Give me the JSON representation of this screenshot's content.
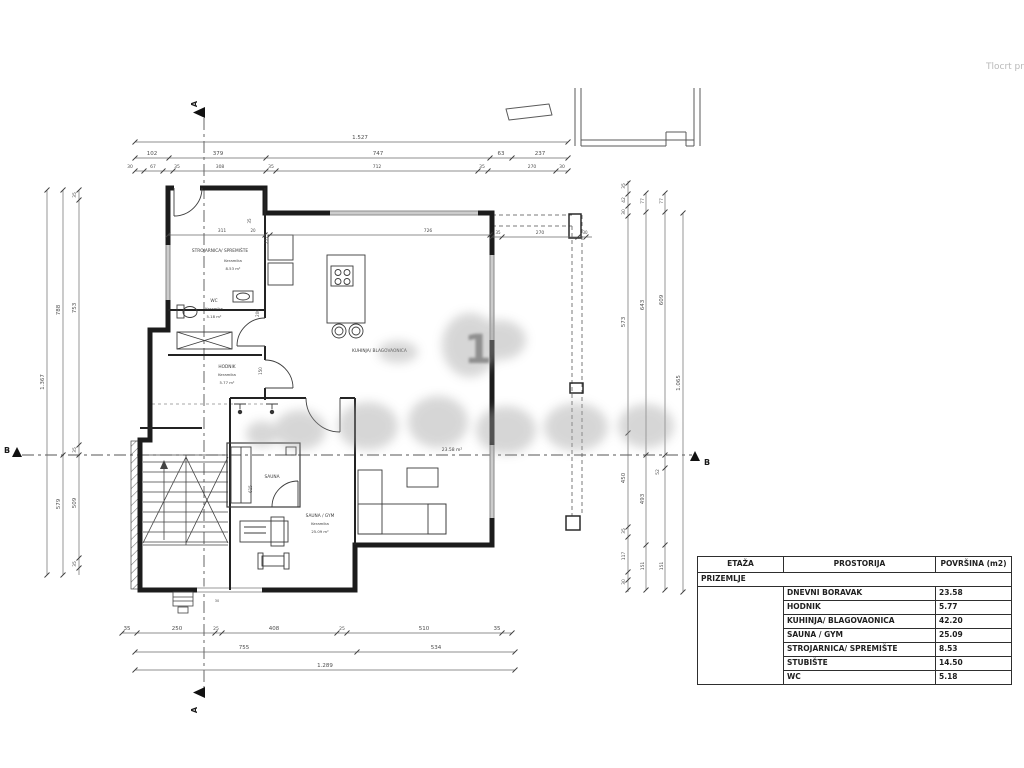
{
  "title": {
    "text": "Tlocrt pr"
  },
  "watermark": {
    "glyph": "1"
  },
  "table": {
    "headers": [
      "ETAŽA",
      "PROSTORIJA",
      "POVRŠINA (m2)"
    ],
    "floor_label": "PRIZEMLJE",
    "rows": [
      [
        "DNEVNI BORAVAK",
        "23.58"
      ],
      [
        "HODNIK",
        "5.77"
      ],
      [
        "KUHINJA/ BLAGOVAONICA",
        "42.20"
      ],
      [
        "SAUNA / GYM",
        "25.09"
      ],
      [
        "STROJARNICA/ SPREMIŠTE",
        "8.53"
      ],
      [
        "STUBIŠTE",
        "14.50"
      ],
      [
        "WC",
        "5.18"
      ]
    ]
  },
  "plan_labels": [
    {
      "t": "1.527",
      "x": 360,
      "y": 139
    },
    {
      "t": "102",
      "x": 152,
      "y": 155
    },
    {
      "t": "379",
      "x": 218,
      "y": 155
    },
    {
      "t": "747",
      "x": 378,
      "y": 155
    },
    {
      "t": "63",
      "x": 501,
      "y": 155
    },
    {
      "t": "237",
      "x": 540,
      "y": 155
    },
    {
      "t": "30",
      "x": 130,
      "y": 168,
      "s": 4.5
    },
    {
      "t": "67",
      "x": 153,
      "y": 168,
      "s": 4.5
    },
    {
      "t": "35",
      "x": 177,
      "y": 168,
      "s": 4.5
    },
    {
      "t": "308",
      "x": 220,
      "y": 168,
      "s": 4.5
    },
    {
      "t": "35",
      "x": 271,
      "y": 168,
      "s": 4.5
    },
    {
      "t": "712",
      "x": 377,
      "y": 168,
      "s": 4.5
    },
    {
      "t": "35",
      "x": 482,
      "y": 168,
      "s": 4.5
    },
    {
      "t": "270",
      "x": 532,
      "y": 168,
      "s": 4.5
    },
    {
      "t": "30",
      "x": 562,
      "y": 168,
      "s": 4.5
    },
    {
      "t": "311",
      "x": 222,
      "y": 232,
      "s": 4.5
    },
    {
      "t": "20",
      "x": 253,
      "y": 232,
      "s": 4
    },
    {
      "t": "726",
      "x": 428,
      "y": 232,
      "s": 4.5
    },
    {
      "t": "35",
      "x": 498,
      "y": 234,
      "s": 4
    },
    {
      "t": "270",
      "x": 540,
      "y": 234,
      "s": 4.5
    },
    {
      "t": "30",
      "x": 585,
      "y": 234,
      "s": 4
    },
    {
      "t": "35",
      "x": 251,
      "y": 221,
      "s": 4,
      "r": -90
    },
    {
      "t": "277",
      "x": 268,
      "y": 240,
      "s": 4,
      "r": -90
    },
    {
      "t": "200",
      "x": 259,
      "y": 313,
      "s": 4,
      "r": -90
    },
    {
      "t": "150",
      "x": 262,
      "y": 371,
      "s": 4,
      "r": -90
    },
    {
      "t": "615",
      "x": 252,
      "y": 489,
      "s": 4,
      "r": -90
    },
    {
      "t": "30",
      "x": 217,
      "y": 602,
      "s": 3.5
    },
    {
      "t": "1.367",
      "x": 44,
      "y": 382,
      "r": -90
    },
    {
      "t": "788",
      "x": 60,
      "y": 310,
      "r": -90
    },
    {
      "t": "579",
      "x": 60,
      "y": 504,
      "r": -90
    },
    {
      "t": "35",
      "x": 76,
      "y": 195,
      "r": -90,
      "s": 4.5
    },
    {
      "t": "753",
      "x": 76,
      "y": 308,
      "r": -90
    },
    {
      "t": "35",
      "x": 76,
      "y": 450,
      "r": -90,
      "s": 4.5
    },
    {
      "t": "509",
      "x": 76,
      "y": 503,
      "r": -90
    },
    {
      "t": "35",
      "x": 76,
      "y": 564,
      "r": -90,
      "s": 4.5
    },
    {
      "t": "35",
      "x": 625,
      "y": 186,
      "r": -90,
      "s": 4.5
    },
    {
      "t": "42",
      "x": 625,
      "y": 200,
      "r": -90,
      "s": 4.5
    },
    {
      "t": "30",
      "x": 625,
      "y": 212,
      "r": -90,
      "s": 4.5
    },
    {
      "t": "573",
      "x": 625,
      "y": 322,
      "r": -90
    },
    {
      "t": "450",
      "x": 625,
      "y": 478,
      "r": -90
    },
    {
      "t": "35",
      "x": 625,
      "y": 531,
      "r": -90,
      "s": 4.5
    },
    {
      "t": "117",
      "x": 625,
      "y": 556,
      "r": -90,
      "s": 4.5
    },
    {
      "t": "30",
      "x": 625,
      "y": 582,
      "r": -90,
      "s": 4.5
    },
    {
      "t": "77",
      "x": 644,
      "y": 201,
      "r": -90,
      "s": 4.5
    },
    {
      "t": "643",
      "x": 644,
      "y": 305,
      "r": -90
    },
    {
      "t": "493",
      "x": 644,
      "y": 499,
      "r": -90
    },
    {
      "t": "151",
      "x": 644,
      "y": 566,
      "r": -90,
      "s": 4.5
    },
    {
      "t": "77",
      "x": 663,
      "y": 201,
      "r": -90,
      "s": 4.5
    },
    {
      "t": "609",
      "x": 663,
      "y": 300,
      "r": -90
    },
    {
      "t": "52",
      "x": 659,
      "y": 472,
      "r": -90,
      "s": 4.5
    },
    {
      "t": "151",
      "x": 663,
      "y": 566,
      "r": -90,
      "s": 4.5
    },
    {
      "t": "1.065",
      "x": 680,
      "y": 383,
      "r": -90
    },
    {
      "t": "35",
      "x": 127,
      "y": 630
    },
    {
      "t": "250",
      "x": 177,
      "y": 630
    },
    {
      "t": "25",
      "x": 216,
      "y": 630,
      "s": 4.5
    },
    {
      "t": "408",
      "x": 274,
      "y": 630
    },
    {
      "t": "25",
      "x": 342,
      "y": 630,
      "s": 4.5
    },
    {
      "t": "510",
      "x": 424,
      "y": 630
    },
    {
      "t": "35",
      "x": 497,
      "y": 630
    },
    {
      "t": "755",
      "x": 244,
      "y": 649
    },
    {
      "t": "534",
      "x": 436,
      "y": 649
    },
    {
      "t": "1.289",
      "x": 325,
      "y": 667
    },
    {
      "t": "STROJARNICA/ SPREMIŠTE",
      "x": 220,
      "y": 252,
      "s": 4.3,
      "cls": "room"
    },
    {
      "t": "Keramika",
      "x": 233,
      "y": 262,
      "s": 3.8,
      "cls": "room"
    },
    {
      "t": "8.53 m²",
      "x": 233,
      "y": 270,
      "s": 3.8,
      "cls": "room"
    },
    {
      "t": "WC",
      "x": 214,
      "y": 302,
      "s": 4.3,
      "cls": "room"
    },
    {
      "t": "Keramika",
      "x": 214,
      "y": 310,
      "s": 3.8,
      "cls": "room"
    },
    {
      "t": "5.18 m²",
      "x": 214,
      "y": 318,
      "s": 3.8,
      "cls": "room"
    },
    {
      "t": "HODNIK",
      "x": 227,
      "y": 368,
      "s": 4.3,
      "cls": "room"
    },
    {
      "t": "Keramika",
      "x": 227,
      "y": 376,
      "s": 3.8,
      "cls": "room"
    },
    {
      "t": "5.77 m²",
      "x": 227,
      "y": 384,
      "s": 3.8,
      "cls": "room"
    },
    {
      "t": "KUHINJA/ BLAGOVAONICA",
      "x": 352,
      "y": 352,
      "s": 4.3,
      "a": "start",
      "cls": "room"
    },
    {
      "t": "23.58 m²",
      "x": 452,
      "y": 451,
      "s": 4.5,
      "cls": "room"
    },
    {
      "t": "SAUNA",
      "x": 272,
      "y": 478,
      "s": 4.3,
      "cls": "room"
    },
    {
      "t": "SAUNA / GYM",
      "x": 320,
      "y": 517,
      "s": 4.3,
      "cls": "room"
    },
    {
      "t": "Keramika",
      "x": 320,
      "y": 525,
      "s": 3.8,
      "cls": "room"
    },
    {
      "t": "25.09 m²",
      "x": 320,
      "y": 533,
      "s": 3.8,
      "cls": "room"
    },
    {
      "t": "A",
      "x": 197,
      "y": 104,
      "s": 8,
      "r": -90,
      "cls": "mark",
      "n": "section-marker-a-top"
    },
    {
      "t": "A",
      "x": 197,
      "y": 710,
      "s": 8,
      "r": -90,
      "cls": "mark",
      "n": "section-marker-a-bottom"
    },
    {
      "t": "B",
      "x": 7,
      "y": 453,
      "s": 8,
      "cls": "mark",
      "n": "section-marker-b-left"
    },
    {
      "t": "B",
      "x": 707,
      "y": 465,
      "s": 8,
      "cls": "mark",
      "n": "section-marker-b-right"
    }
  ]
}
